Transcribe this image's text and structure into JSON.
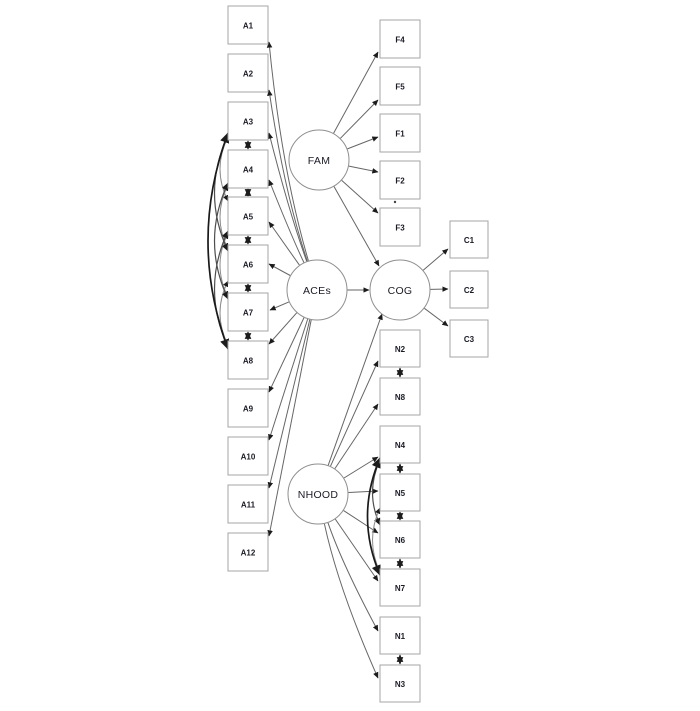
{
  "canvas": {
    "width": 700,
    "height": 711,
    "background": "#ffffff"
  },
  "styles": {
    "box_fill": "#ffffff",
    "box_stroke": "#a6a6a6",
    "circle_fill": "#ffffff",
    "circle_stroke": "#8f8f8f",
    "edge_stroke": "#666666",
    "arrow_fill": "#1c1c1c",
    "cov_stroke": "#2b2b2b",
    "arc_thin_stroke": "#8c8c8c",
    "arc_mid_stroke": "#4d4d4d",
    "arc_thick_stroke": "#1a1a1a",
    "label_color": "#1b1b26",
    "dot_color": "#444444"
  },
  "diagram": {
    "latents": [
      {
        "id": "FAM",
        "label": "FAM",
        "cx": 319,
        "cy": 160,
        "r": 30
      },
      {
        "id": "ACEs",
        "label": "ACEs",
        "cx": 317,
        "cy": 290,
        "r": 30
      },
      {
        "id": "COG",
        "label": "COG",
        "cx": 400,
        "cy": 290,
        "r": 30
      },
      {
        "id": "NHOOD",
        "label": "NHOOD",
        "cx": 318,
        "cy": 494,
        "r": 30
      }
    ],
    "indicators": [
      {
        "id": "A1",
        "label": "A1",
        "x": 228,
        "y": 6,
        "w": 40,
        "h": 38
      },
      {
        "id": "A2",
        "label": "A2",
        "x": 228,
        "y": 54,
        "w": 40,
        "h": 38
      },
      {
        "id": "A3",
        "label": "A3",
        "x": 228,
        "y": 102,
        "w": 40,
        "h": 38
      },
      {
        "id": "A4",
        "label": "A4",
        "x": 228,
        "y": 150,
        "w": 40,
        "h": 38
      },
      {
        "id": "A5",
        "label": "A5",
        "x": 228,
        "y": 197,
        "w": 40,
        "h": 38
      },
      {
        "id": "A6",
        "label": "A6",
        "x": 228,
        "y": 245,
        "w": 40,
        "h": 38
      },
      {
        "id": "A7",
        "label": "A7",
        "x": 228,
        "y": 293,
        "w": 40,
        "h": 38
      },
      {
        "id": "A8",
        "label": "A8",
        "x": 228,
        "y": 341,
        "w": 40,
        "h": 38
      },
      {
        "id": "A9",
        "label": "A9",
        "x": 228,
        "y": 389,
        "w": 40,
        "h": 38
      },
      {
        "id": "A10",
        "label": "A10",
        "x": 228,
        "y": 437,
        "w": 40,
        "h": 38
      },
      {
        "id": "A11",
        "label": "A11",
        "x": 228,
        "y": 485,
        "w": 40,
        "h": 38
      },
      {
        "id": "A12",
        "label": "A12",
        "x": 228,
        "y": 533,
        "w": 40,
        "h": 38
      },
      {
        "id": "F4",
        "label": "F4",
        "x": 380,
        "y": 20,
        "w": 40,
        "h": 38
      },
      {
        "id": "F5",
        "label": "F5",
        "x": 380,
        "y": 67,
        "w": 40,
        "h": 38
      },
      {
        "id": "F1",
        "label": "F1",
        "x": 380,
        "y": 114,
        "w": 40,
        "h": 38
      },
      {
        "id": "F2",
        "label": "F2",
        "x": 380,
        "y": 161,
        "w": 40,
        "h": 38
      },
      {
        "id": "F3",
        "label": "F3",
        "x": 380,
        "y": 208,
        "w": 40,
        "h": 38
      },
      {
        "id": "C1",
        "label": "C1",
        "x": 450,
        "y": 221,
        "w": 38,
        "h": 37
      },
      {
        "id": "C2",
        "label": "C2",
        "x": 450,
        "y": 271,
        "w": 38,
        "h": 37
      },
      {
        "id": "C3",
        "label": "C3",
        "x": 450,
        "y": 320,
        "w": 38,
        "h": 37
      },
      {
        "id": "N2",
        "label": "N2",
        "x": 380,
        "y": 330,
        "w": 40,
        "h": 37
      },
      {
        "id": "N8",
        "label": "N8",
        "x": 380,
        "y": 378,
        "w": 40,
        "h": 37
      },
      {
        "id": "N4",
        "label": "N4",
        "x": 380,
        "y": 426,
        "w": 40,
        "h": 37
      },
      {
        "id": "N5",
        "label": "N5",
        "x": 380,
        "y": 474,
        "w": 40,
        "h": 37
      },
      {
        "id": "N6",
        "label": "N6",
        "x": 380,
        "y": 521,
        "w": 40,
        "h": 37
      },
      {
        "id": "N7",
        "label": "N7",
        "x": 380,
        "y": 569,
        "w": 40,
        "h": 37
      },
      {
        "id": "N1",
        "label": "N1",
        "x": 380,
        "y": 617,
        "w": 40,
        "h": 37
      },
      {
        "id": "N3",
        "label": "N3",
        "x": 380,
        "y": 665,
        "w": 40,
        "h": 37
      }
    ],
    "paths": [
      {
        "from": "ACEs",
        "to": "A1",
        "end": [
          269,
          42
        ],
        "bend": -12
      },
      {
        "from": "ACEs",
        "to": "A2",
        "end": [
          269,
          90
        ],
        "bend": -9
      },
      {
        "from": "ACEs",
        "to": "A3",
        "end": [
          269,
          133
        ],
        "bend": -4
      },
      {
        "from": "ACEs",
        "to": "A4",
        "end": [
          269,
          180
        ],
        "bend": -2
      },
      {
        "from": "ACEs",
        "to": "A5",
        "end": [
          269,
          222
        ],
        "bend": 0
      },
      {
        "from": "ACEs",
        "to": "A6",
        "end": [
          269,
          264
        ],
        "bend": 0
      },
      {
        "from": "ACEs",
        "to": "A7",
        "end": [
          270,
          310
        ],
        "bend": 0
      },
      {
        "from": "ACEs",
        "to": "A8",
        "end": [
          269,
          344
        ],
        "bend": 0
      },
      {
        "from": "ACEs",
        "to": "A9",
        "end": [
          269,
          392
        ],
        "bend": 0
      },
      {
        "from": "ACEs",
        "to": "A10",
        "end": [
          269,
          440
        ],
        "bend": 0
      },
      {
        "from": "ACEs",
        "to": "A11",
        "end": [
          269,
          488
        ],
        "bend": 0
      },
      {
        "from": "ACEs",
        "to": "A12",
        "end": [
          269,
          536
        ],
        "bend": 0
      },
      {
        "from": "ACEs",
        "to": "COG",
        "end": [
          369,
          290
        ],
        "bend": 0
      },
      {
        "from": "FAM",
        "to": "F4",
        "end": [
          378,
          52
        ],
        "bend": 0
      },
      {
        "from": "FAM",
        "to": "F5",
        "end": [
          378,
          100
        ],
        "bend": 0
      },
      {
        "from": "FAM",
        "to": "F1",
        "end": [
          378,
          137
        ],
        "bend": 0
      },
      {
        "from": "FAM",
        "to": "F2",
        "end": [
          378,
          172
        ],
        "bend": 0
      },
      {
        "from": "FAM",
        "to": "F3",
        "end": [
          378,
          213
        ],
        "bend": 0
      },
      {
        "from": "FAM",
        "to": "COG",
        "end": [
          379,
          266
        ],
        "bend": 0
      },
      {
        "from": "NHOOD",
        "to": "N2",
        "end": [
          378,
          361
        ],
        "bend": 0
      },
      {
        "from": "NHOOD",
        "to": "N8",
        "end": [
          378,
          404
        ],
        "bend": 0
      },
      {
        "from": "NHOOD",
        "to": "N4",
        "end": [
          378,
          457
        ],
        "bend": 0
      },
      {
        "from": "NHOOD",
        "to": "N5",
        "end": [
          378,
          491
        ],
        "bend": 0
      },
      {
        "from": "NHOOD",
        "to": "N6",
        "end": [
          378,
          533
        ],
        "bend": 0
      },
      {
        "from": "NHOOD",
        "to": "N7",
        "end": [
          378,
          581
        ],
        "bend": 0
      },
      {
        "from": "NHOOD",
        "to": "N1",
        "end": [
          378,
          631
        ],
        "bend": 6
      },
      {
        "from": "NHOOD",
        "to": "N3",
        "end": [
          378,
          678
        ],
        "bend": 10
      },
      {
        "from": "NHOOD",
        "to": "COG",
        "end": [
          382,
          314
        ],
        "bend": 0
      },
      {
        "from": "COG",
        "to": "C1",
        "end": [
          448,
          249
        ],
        "bend": 0
      },
      {
        "from": "COG",
        "to": "C2",
        "end": [
          448,
          289
        ],
        "bend": 0
      },
      {
        "from": "COG",
        "to": "C3",
        "end": [
          448,
          326
        ],
        "bend": 0
      }
    ],
    "covariances_straight": [
      {
        "a": "A3",
        "b": "A4",
        "x": 248,
        "y1": 141,
        "y2": 149
      },
      {
        "a": "A4",
        "b": "A5",
        "x": 248,
        "y1": 189,
        "y2": 196
      },
      {
        "a": "A5",
        "b": "A6",
        "x": 248,
        "y1": 236,
        "y2": 244
      },
      {
        "a": "A6",
        "b": "A7",
        "x": 248,
        "y1": 284,
        "y2": 292
      },
      {
        "a": "A7",
        "b": "A8",
        "x": 248,
        "y1": 332,
        "y2": 340
      },
      {
        "a": "N2",
        "b": "N8",
        "x": 400,
        "y1": 368,
        "y2": 377
      },
      {
        "a": "N4",
        "b": "N5",
        "x": 400,
        "y1": 464,
        "y2": 473
      },
      {
        "a": "N5",
        "b": "N6",
        "x": 400,
        "y1": 512,
        "y2": 520
      },
      {
        "a": "N6",
        "b": "N7",
        "x": 400,
        "y1": 559,
        "y2": 568
      },
      {
        "a": "N1",
        "b": "N3",
        "x": 400,
        "y1": 655,
        "y2": 664
      }
    ],
    "covariances_arc": [
      {
        "a": "A3",
        "b": "A5",
        "x": 228,
        "y1": 137,
        "y2": 201,
        "bulge": 16,
        "cls": "thin"
      },
      {
        "a": "A4",
        "b": "A6",
        "x": 228,
        "y1": 185,
        "y2": 249,
        "bulge": 16,
        "cls": "thin"
      },
      {
        "a": "A5",
        "b": "A7",
        "x": 228,
        "y1": 233,
        "y2": 297,
        "bulge": 16,
        "cls": "thin"
      },
      {
        "a": "A6",
        "b": "A8",
        "x": 228,
        "y1": 281,
        "y2": 345,
        "bulge": 16,
        "cls": "thin"
      },
      {
        "a": "A3",
        "b": "A6",
        "x": 228,
        "y1": 135,
        "y2": 251,
        "bulge": 27,
        "cls": "mid"
      },
      {
        "a": "A4",
        "b": "A7",
        "x": 228,
        "y1": 183,
        "y2": 299,
        "bulge": 27,
        "cls": "mid"
      },
      {
        "a": "A5",
        "b": "A8",
        "x": 228,
        "y1": 231,
        "y2": 347,
        "bulge": 27,
        "cls": "mid"
      },
      {
        "a": "A3",
        "b": "A8",
        "x": 228,
        "y1": 133,
        "y2": 349,
        "bulge": 40,
        "cls": "thick"
      },
      {
        "a": "N4",
        "b": "N6",
        "x": 380,
        "y1": 460,
        "y2": 525,
        "bulge": 15,
        "cls": "mid"
      },
      {
        "a": "N5",
        "b": "N7",
        "x": 380,
        "y1": 508,
        "y2": 572,
        "bulge": 15,
        "cls": "thin"
      },
      {
        "a": "N4",
        "b": "N7",
        "x": 380,
        "y1": 458,
        "y2": 575,
        "bulge": 25,
        "cls": "thick"
      }
    ],
    "artifact_dot": {
      "x": 395,
      "y": 202
    }
  }
}
